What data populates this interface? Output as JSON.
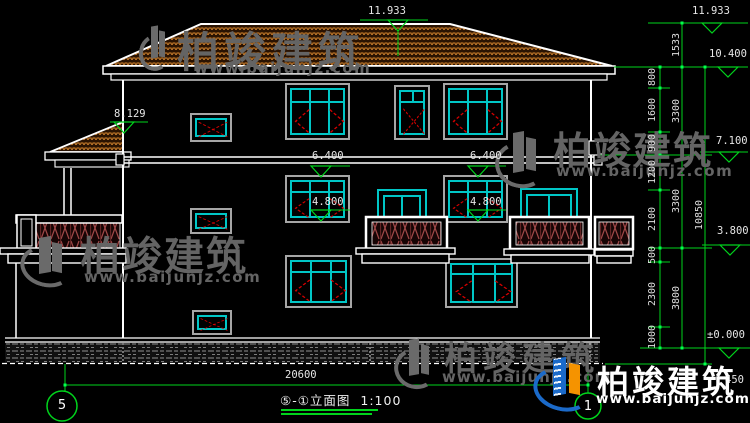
{
  "drawing": {
    "levels": {
      "ridge_left": "11.933",
      "ridge_right": "11.933",
      "eave": "10.400",
      "wing_roof": "8.129",
      "floor3": "7.100",
      "floor2": "3.800",
      "ground": "±0.000",
      "win_head_left": "6.400",
      "win_head_right": "6.400",
      "win_sill_left": "4.800",
      "win_sill_right": "4.800"
    },
    "dims": {
      "segments": [
        "800",
        "1600",
        "900",
        "1200",
        "2100",
        "500",
        "2300",
        "1000"
      ],
      "floors": [
        "1533",
        "3300",
        "3300",
        "3800"
      ],
      "overall_height": "10850",
      "plinth": "450",
      "overall_width": "20600"
    },
    "axes": {
      "left": "5",
      "right": "1"
    },
    "title": {
      "name": "⑤-①立面图",
      "scale": "1:100"
    },
    "colors": {
      "dimension_green": "#00d41c",
      "window_cyan": "#00c6c6",
      "open_arrow_red": "#d40000",
      "roof_tile_orange": "#c97e2d",
      "outline_white": "#ffffff"
    }
  },
  "watermark": {
    "brand": "柏竣建筑",
    "url": "www.baijunjz.com"
  },
  "footer_logo": {
    "brand": "柏竣建筑",
    "url": "www.baijunjz.com"
  }
}
